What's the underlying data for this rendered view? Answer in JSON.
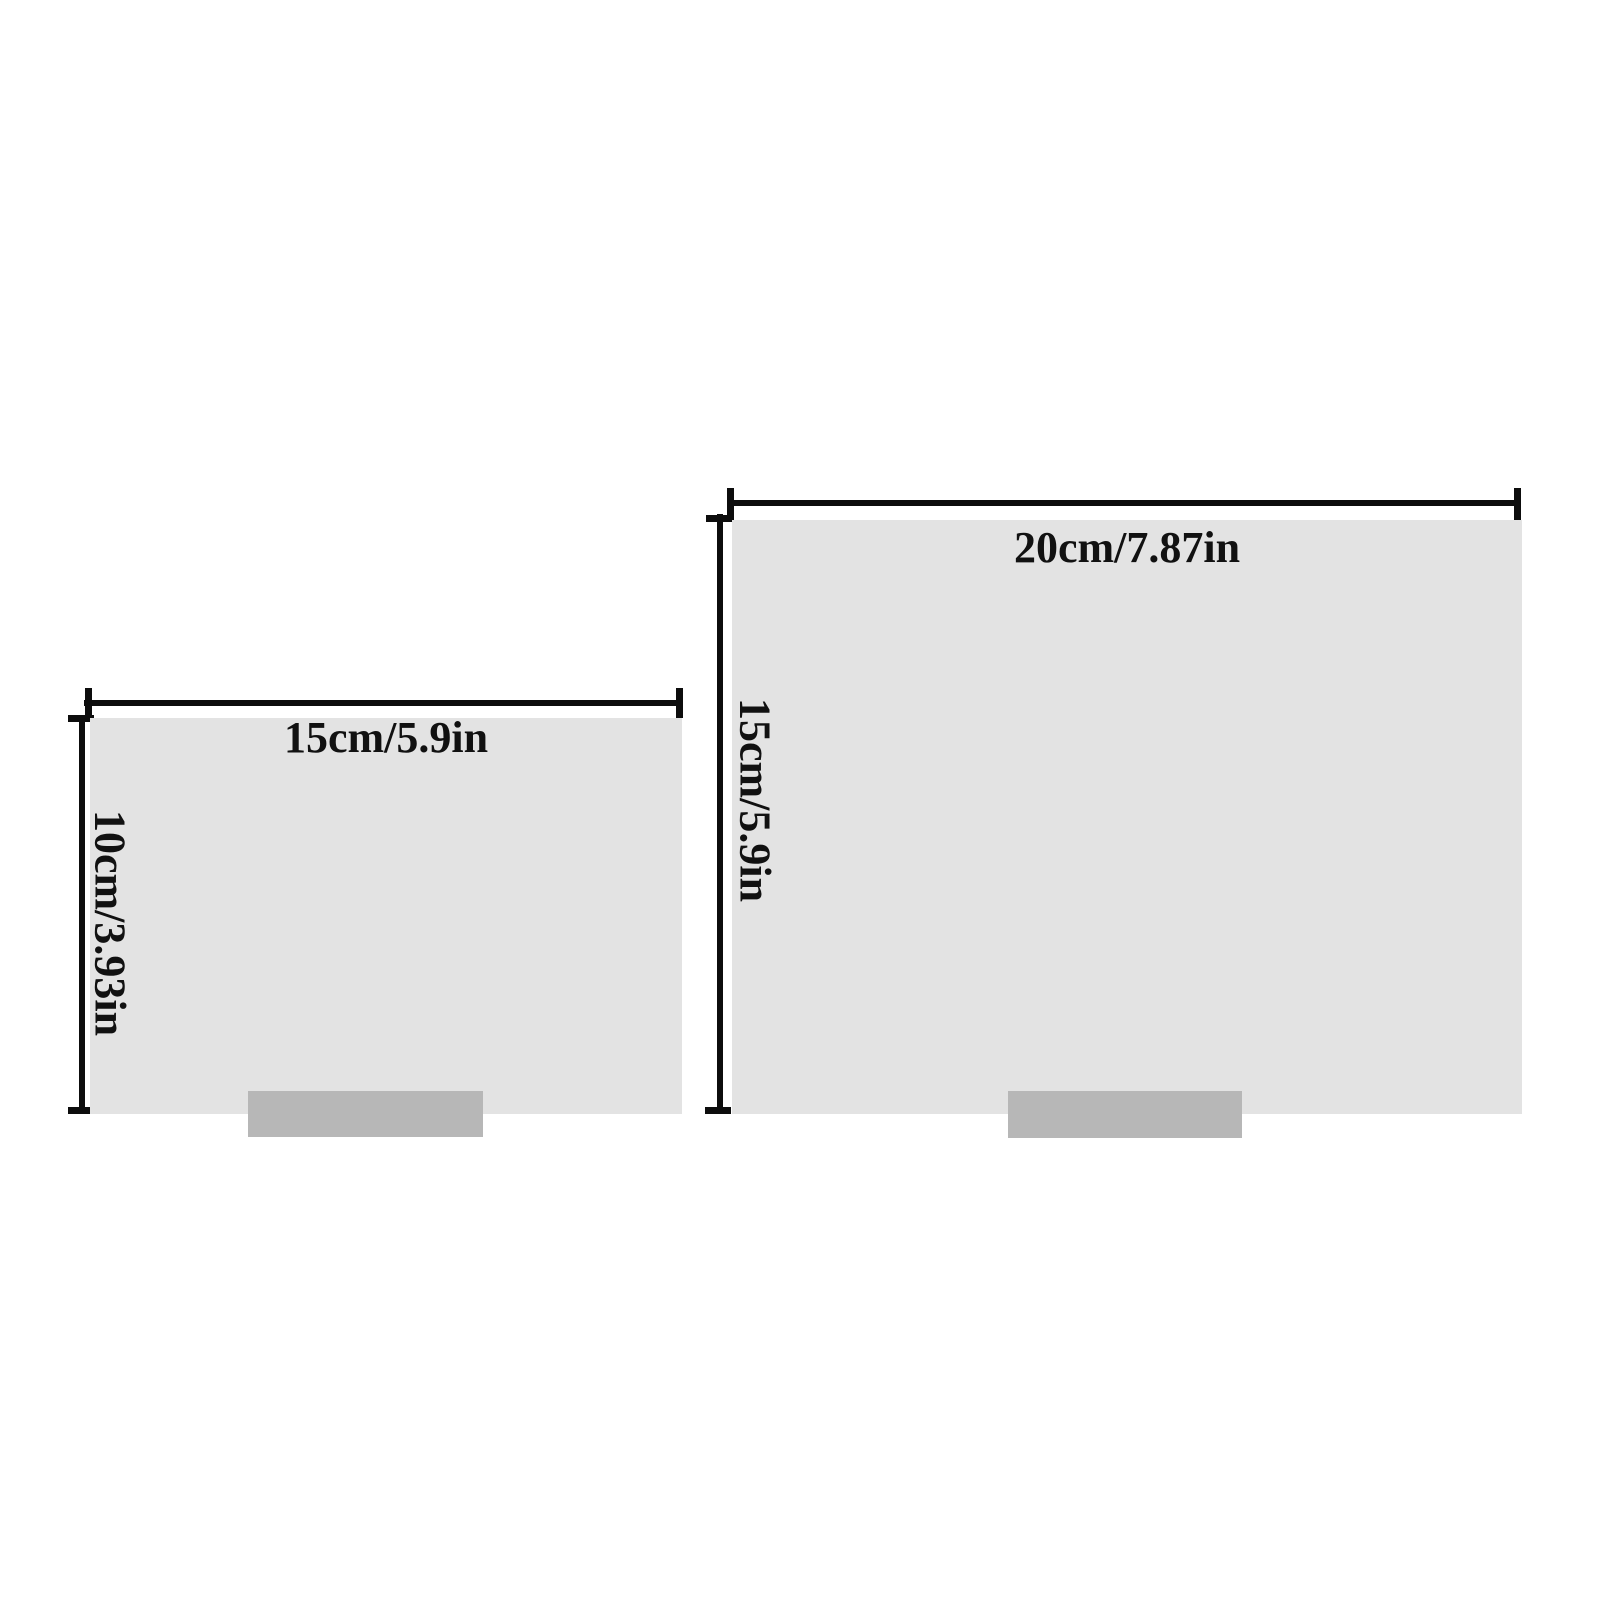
{
  "colors": {
    "background": "#ffffff",
    "panel_fill": "#e3e3e3",
    "stand_fill": "#b7b7b7",
    "dimension_line": "#0d0d0d",
    "label_text": "#111111"
  },
  "diagrams": {
    "small": {
      "width_label": "15cm/5.9in",
      "height_label": "10cm/3.93in"
    },
    "large": {
      "width_label": "20cm/7.87in",
      "height_label": "15cm/5.9in"
    }
  }
}
